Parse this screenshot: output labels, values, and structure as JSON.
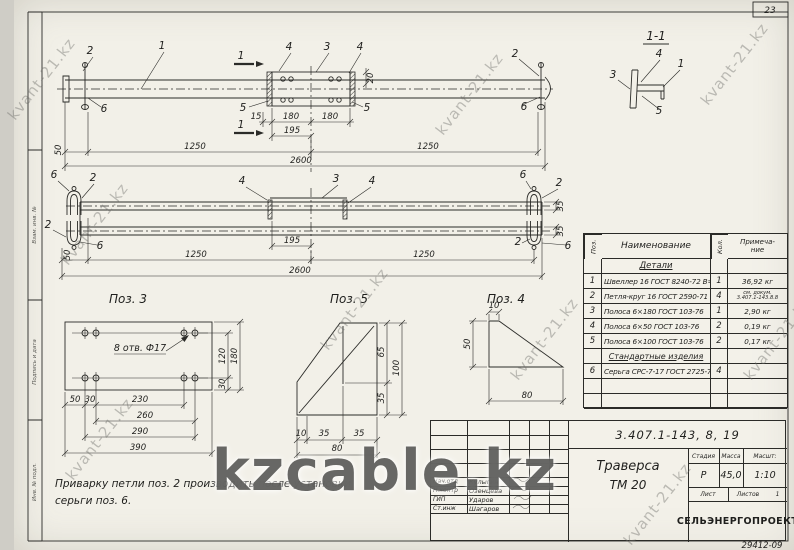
{
  "page": {
    "corner_number": "23",
    "bottom_code": "29412-09"
  },
  "watermarks": {
    "small": "kvant-21.kz",
    "large": "kzcable.kz"
  },
  "frame_sidebar": {
    "f1": "Взам. инв. №",
    "f2": "Подпись и дата",
    "f3": "Инв. № подл."
  },
  "note": {
    "line1": "Приварку петли поз. 2 производить после установки",
    "line2": "серьги  поз. 6."
  },
  "views": {
    "section_label": "1-1",
    "pos3_title": "Поз. 3",
    "pos5_title": "Поз. 5",
    "pos4_title": "Поз. 4",
    "hole_note": "8 отв. Ф17"
  },
  "callouts": {
    "v1": {
      "a": "2",
      "b": "1",
      "c": "4",
      "d": "3",
      "e": "4",
      "f": "5",
      "g": "5",
      "h": "2",
      "i": "6",
      "j": "6",
      "sec": "1"
    },
    "v2": {
      "a": "6",
      "b": "2",
      "c": "2",
      "d": "6",
      "e": "4",
      "f": "3",
      "g": "4",
      "h": "6",
      "i": "2",
      "j": "2",
      "k": "6"
    },
    "s11": {
      "a": "4",
      "b": "1",
      "c": "3",
      "d": "5"
    }
  },
  "dims": {
    "v1": {
      "d15": "15",
      "d180a": "180",
      "d180b": "180",
      "d195": "195",
      "d1250a": "1250",
      "d1250b": "1250",
      "d2600": "2600",
      "d50": "50",
      "d20": "20"
    },
    "v2": {
      "d195": "195",
      "d1250a": "1250",
      "d1250b": "1250",
      "d2600": "2600",
      "d50": "50",
      "d35a": "35",
      "d35b": "35"
    },
    "p3": {
      "d50": "50",
      "d30a": "30",
      "d230": "230",
      "d260": "260",
      "d290": "290",
      "d390": "390",
      "d120": "120",
      "d30b": "30",
      "d180": "180"
    },
    "p5": {
      "d65": "65",
      "d100": "100",
      "d35a": "35",
      "d10": "10",
      "d35b": "35",
      "d35c": "35",
      "d80": "80"
    },
    "p4": {
      "d10": "10",
      "d50": "50",
      "d80": "80"
    }
  },
  "parts_table": {
    "h_pos": "Поз.",
    "h_name": "Наименование",
    "h_qty": "Кол.",
    "h_note1": "Примеча-",
    "h_note2": "ние",
    "section1": "Детали",
    "rows1": [
      {
        "pos": "1",
        "name": "Швеллер 16 ГОСТ 8240-72 В=2600",
        "qty": "1",
        "note": "36,92 кг"
      },
      {
        "pos": "2",
        "name": "Петля-круг 16 ГОСТ 2590-71",
        "qty": "4",
        "note1": "см. докум.",
        "note2": "3.407.1-143.8.8"
      },
      {
        "pos": "3",
        "name": "Полоса 6×180  ГОСТ 103-76",
        "qty": "1",
        "note": "2,90 кг"
      },
      {
        "pos": "4",
        "name": "Полоса 6×50  ГОСТ 103-76",
        "qty": "2",
        "note": "0,19 кг"
      },
      {
        "pos": "5",
        "name": "Полоса 6×100  ГОСТ 103-76",
        "qty": "2",
        "note": "0,17 кг"
      }
    ],
    "section2": "Стандартные изделия",
    "rows2": [
      {
        "pos": "6",
        "name": "Серьга СРС-7-17 ГОСТ 2725-78",
        "qty": "4",
        "note": ""
      }
    ]
  },
  "title_block": {
    "doc_number": "3.407.1-143, 8, 19",
    "title1": "Траверса",
    "title2": "ТМ 20",
    "stage_label": "Стадия",
    "mass_label": "Масса",
    "scale_label": "Масшт:",
    "stage": "Р",
    "mass": "45,0",
    "scale": "1:10",
    "sheet_label": "Лист",
    "sheets_label": "Листов",
    "sheets_value": "1",
    "organization": "СЕЛЬЭНЕРГОПРОЕКТ",
    "sig": [
      {
        "role": "Нач.отд",
        "name": "Кулыгин"
      },
      {
        "role": "Н.контр",
        "name": "Озенцева"
      },
      {
        "role": "ГИП",
        "name": "Ударов"
      },
      {
        "role": "Ст.инж",
        "name": "Шагаров"
      }
    ]
  }
}
